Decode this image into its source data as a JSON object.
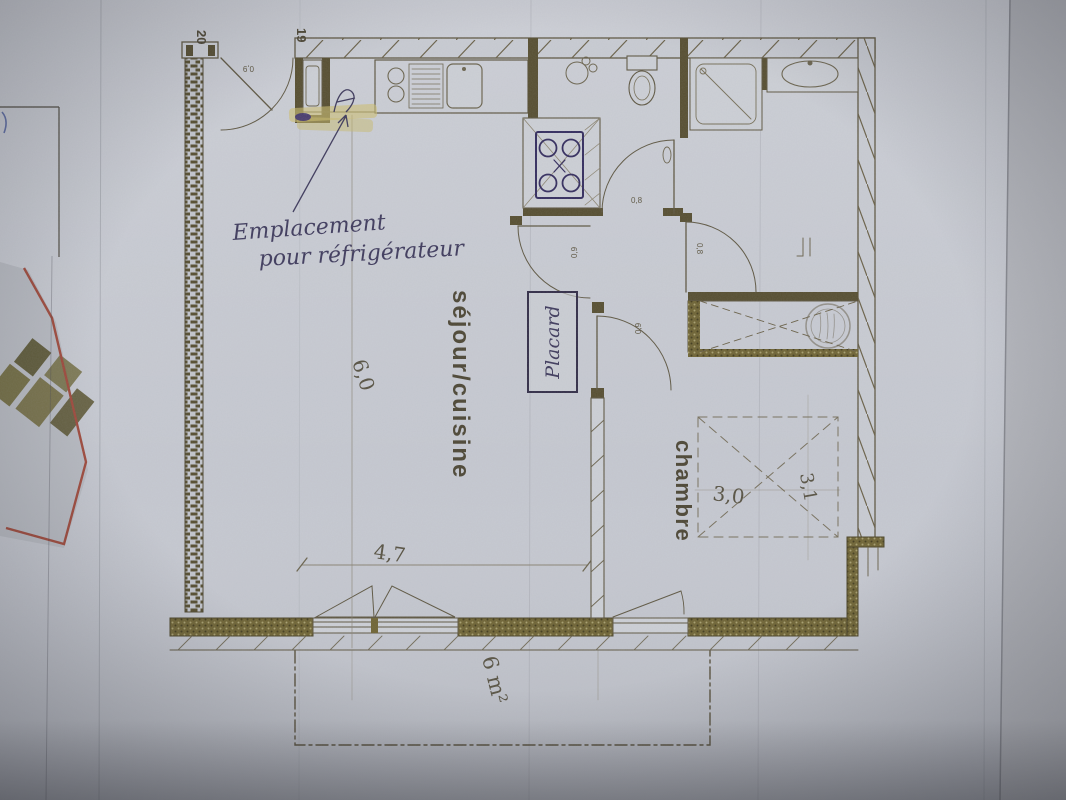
{
  "floorplan": {
    "rooms": [
      {
        "id": "sejour-cuisine",
        "label": "séjour/cuisine"
      },
      {
        "id": "chambre",
        "label": "chambre"
      }
    ],
    "handwritten_notes": {
      "fridge_line1": "Emplacement",
      "fridge_line2": "pour réfrigérateur",
      "closet": "Placard"
    },
    "dimensions": {
      "sejour_length": "6,0",
      "sejour_width": "4,7",
      "chambre_width": "3,0",
      "chambre_depth": "3,1",
      "balcony_area": "6 m²"
    },
    "door_widths": {
      "entry": "0,9",
      "bathroom": "0,8",
      "hall_left": "0,9",
      "chambre": "0,8",
      "hall_lower": "0,9"
    },
    "grid_marks": {
      "left": "20",
      "right": "19"
    },
    "colors": {
      "paper": "#c6c9d1",
      "print_line": "#5e5742",
      "dark_wall": "#564e30",
      "hand_ink": "#3e3a5c",
      "stove_ink": "#332c5e",
      "highlighter": "#cfbf72",
      "underlay_red": "#a04a3c"
    }
  }
}
